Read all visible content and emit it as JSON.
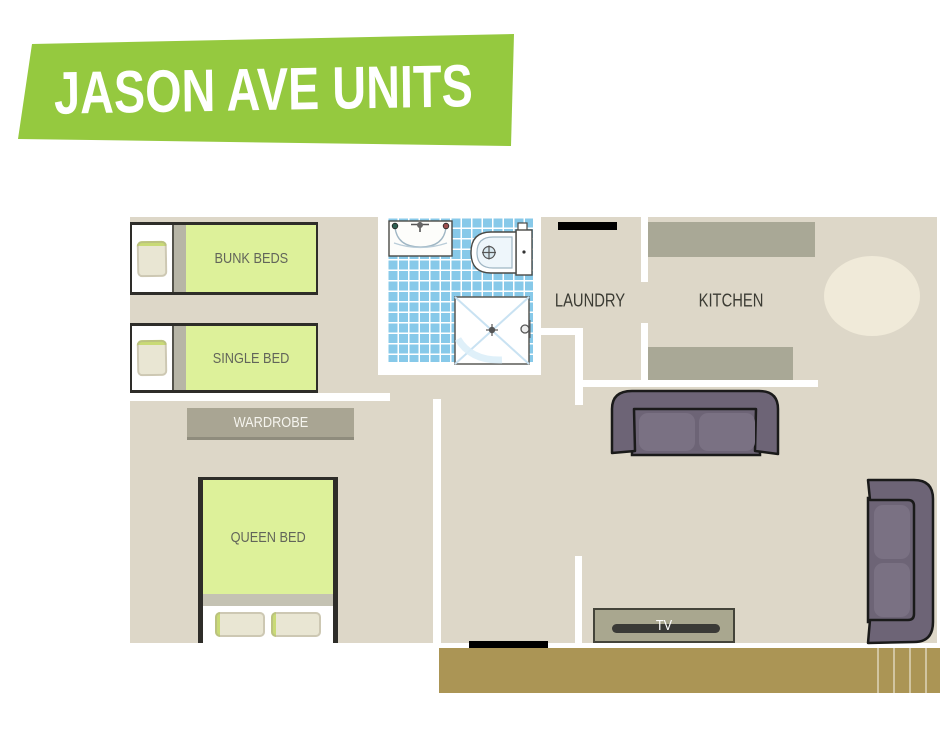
{
  "banner": {
    "title": "JASON AVE UNITS"
  },
  "rooms": {
    "laundry_label": "LAUNDRY",
    "kitchen_label": "KITCHEN"
  },
  "furniture": {
    "bunk_beds_label": "BUNK BEDS",
    "single_bed_label": "SINGLE BED",
    "wardrobe_label": "WARDROBE",
    "queen_bed_label": "QUEEN BED",
    "tv_label": "TV"
  },
  "icons": {
    "sink": "sink-icon",
    "toilet": "toilet-icon",
    "shower": "shower-icon",
    "sofa_top": "sofa-icon",
    "sofa_right": "sofa-icon",
    "dining_table": "round-table-icon"
  },
  "colors": {
    "banner_green": "#95c93f",
    "floor_beige": "#ddd7c8",
    "bed_green": "#ddf19a",
    "counter_olive": "#a9a896",
    "sofa_purple": "#6d6476",
    "sofa_cushion": "#7a7183",
    "deck_gold": "#ab9555",
    "tile_blue": "#87c9e9"
  }
}
